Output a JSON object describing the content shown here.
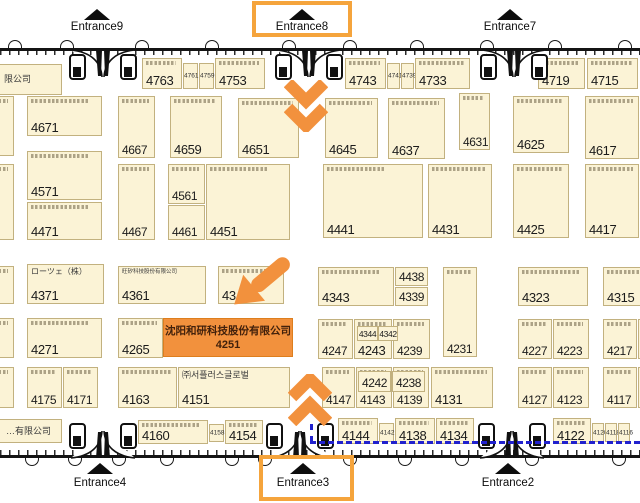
{
  "colors": {
    "booth_fill": "#FBF3D6",
    "booth_border": "#C2B17F",
    "highlight_orange": "#F2913D",
    "entrance_box_orange": "#F5A43C",
    "route_blue": "#2121CE",
    "wall_black": "#141414",
    "number_text": "#1b1b1b",
    "highlight_text": "#42210B"
  },
  "highlight_booth": {
    "company": "沈阳和研科技股份有限公司",
    "number": "4251",
    "x": 163,
    "y": 318,
    "w": 130,
    "h": 39
  },
  "entrances": {
    "top": [
      {
        "name": "Entrance9",
        "cx": 97,
        "door_cx": 103,
        "highlighted": false
      },
      {
        "name": "Entrance8",
        "cx": 302,
        "door_cx": 309,
        "highlighted": true
      },
      {
        "name": "Entrance7",
        "cx": 510,
        "door_cx": 514,
        "highlighted": false
      }
    ],
    "bottom": [
      {
        "name": "Entrance4",
        "cx": 100,
        "door_cx": 103,
        "highlighted": false
      },
      {
        "name": "Entrance3",
        "cx": 303,
        "door_cx": 300,
        "highlighted": true
      },
      {
        "name": "Entrance2",
        "cx": 508,
        "door_cx": 512,
        "highlighted": false
      }
    ]
  },
  "entrance_highlight_rects": [
    {
      "x": 252,
      "y": 1,
      "w": 100,
      "h": 36,
      "for": "Entrance8"
    },
    {
      "x": 259,
      "y": 455,
      "w": 95,
      "h": 46,
      "for": "Entrance3"
    }
  ],
  "booths": [
    {
      "lb": "限公司",
      "x": -46,
      "y": 64,
      "w": 108,
      "h": 31,
      "ls": 9,
      "lx": 49,
      "ly": 9
    },
    {
      "n": "4763",
      "x": 142,
      "y": 58,
      "w": 40,
      "h": 31,
      "m": 1
    },
    {
      "n": "4761",
      "x": 183,
      "y": 63,
      "w": 15,
      "h": 26,
      "s": 1
    },
    {
      "n": "4759",
      "x": 199,
      "y": 63,
      "w": 15,
      "h": 26,
      "s": 1
    },
    {
      "n": "4753",
      "x": 215,
      "y": 58,
      "w": 50,
      "h": 31,
      "m": 1
    },
    {
      "n": "4743",
      "x": 345,
      "y": 58,
      "w": 41,
      "h": 31,
      "m": 1
    },
    {
      "n": "4741",
      "x": 387,
      "y": 63,
      "w": 13,
      "h": 26,
      "s": 1
    },
    {
      "n": "4739",
      "x": 401,
      "y": 63,
      "w": 13,
      "h": 26,
      "s": 1
    },
    {
      "n": "4733",
      "x": 415,
      "y": 58,
      "w": 55,
      "h": 31,
      "m": 1
    },
    {
      "n": "4719",
      "x": 538,
      "y": 58,
      "w": 47,
      "h": 31,
      "m": 1
    },
    {
      "n": "4715",
      "x": 587,
      "y": 58,
      "w": 51,
      "h": 31,
      "m": 1
    },
    {
      "n": "4671",
      "x": 27,
      "y": 96,
      "w": 75,
      "h": 40,
      "m": 1
    },
    {
      "n": "4667",
      "x": 118,
      "y": 96,
      "w": 37,
      "h": 62,
      "m": 1
    },
    {
      "n": "4659",
      "x": 170,
      "y": 96,
      "w": 52,
      "h": 62,
      "m": 1
    },
    {
      "n": "4651",
      "x": 238,
      "y": 98,
      "w": 61,
      "h": 60,
      "m": 1
    },
    {
      "n": "4645",
      "x": 325,
      "y": 98,
      "w": 53,
      "h": 60,
      "m": 1
    },
    {
      "n": "4637",
      "x": 388,
      "y": 98,
      "w": 57,
      "h": 61,
      "m": 1
    },
    {
      "n": "4631",
      "x": 459,
      "y": 93,
      "w": 31,
      "h": 57,
      "m": 1
    },
    {
      "n": "4625",
      "x": 513,
      "y": 96,
      "w": 56,
      "h": 57,
      "m": 1
    },
    {
      "n": "4617",
      "x": 585,
      "y": 96,
      "w": 54,
      "h": 63,
      "m": 1
    },
    {
      "n": "4571",
      "x": 27,
      "y": 151,
      "w": 75,
      "h": 49,
      "m": 1
    },
    {
      "n": "4471",
      "x": 27,
      "y": 202,
      "w": 75,
      "h": 38,
      "m": 1
    },
    {
      "n": "4467",
      "x": 118,
      "y": 164,
      "w": 37,
      "h": 76,
      "m": 1
    },
    {
      "n": "4561",
      "x": 168,
      "y": 164,
      "w": 37,
      "h": 40,
      "m": 1
    },
    {
      "n": "4461",
      "x": 168,
      "y": 205,
      "w": 37,
      "h": 35
    },
    {
      "n": "4451",
      "x": 206,
      "y": 164,
      "w": 84,
      "h": 76,
      "m": 1
    },
    {
      "n": "4441",
      "x": 323,
      "y": 164,
      "w": 100,
      "h": 74,
      "m": 1
    },
    {
      "n": "4431",
      "x": 428,
      "y": 164,
      "w": 64,
      "h": 74,
      "m": 1
    },
    {
      "n": "4425",
      "x": 513,
      "y": 164,
      "w": 56,
      "h": 74,
      "m": 1
    },
    {
      "n": "4417",
      "x": 585,
      "y": 164,
      "w": 54,
      "h": 74,
      "m": 1
    },
    {
      "n": "4371",
      "x": 27,
      "y": 264,
      "w": 77,
      "h": 40,
      "lb": "ローツェ（株）",
      "ls": 8
    },
    {
      "n": "4361",
      "x": 118,
      "y": 266,
      "w": 88,
      "h": 38,
      "lb": "旺矽科技股份有限公司",
      "ls": 5.5
    },
    {
      "n": "43",
      "x": 218,
      "y": 266,
      "w": 66,
      "h": 38,
      "m": 1
    },
    {
      "n": "4343",
      "x": 318,
      "y": 267,
      "w": 76,
      "h": 39,
      "m": 1
    },
    {
      "n": "4438",
      "x": 395,
      "y": 267,
      "w": 33,
      "h": 19,
      "ctr": 1,
      "fs": 12
    },
    {
      "n": "4339",
      "x": 395,
      "y": 287,
      "w": 33,
      "h": 19,
      "ctr": 1,
      "fs": 12
    },
    {
      "n": "4231",
      "x": 443,
      "y": 267,
      "w": 34,
      "h": 90,
      "m": 1
    },
    {
      "n": "4323",
      "x": 518,
      "y": 267,
      "w": 70,
      "h": 39,
      "m": 1
    },
    {
      "n": "4315",
      "x": 603,
      "y": 267,
      "w": 43,
      "h": 39,
      "m": 1
    },
    {
      "n": "4271",
      "x": 27,
      "y": 318,
      "w": 75,
      "h": 40,
      "m": 1
    },
    {
      "n": "4265",
      "x": 118,
      "y": 318,
      "w": 45,
      "h": 40,
      "m": 1
    },
    {
      "n": "4247",
      "x": 318,
      "y": 319,
      "w": 35,
      "h": 40,
      "m": 1
    },
    {
      "n": "4243",
      "x": 354,
      "y": 319,
      "w": 38,
      "h": 40,
      "m": 1
    },
    {
      "n": "4344",
      "x": 357,
      "y": 326,
      "w": 21,
      "h": 15,
      "ctr": 1,
      "fs": 8.5
    },
    {
      "n": "4342",
      "x": 378,
      "y": 326,
      "w": 20,
      "h": 15,
      "ctr": 1,
      "fs": 8.5
    },
    {
      "n": "4239",
      "x": 393,
      "y": 319,
      "w": 37,
      "h": 40,
      "m": 1
    },
    {
      "n": "4227",
      "x": 518,
      "y": 319,
      "w": 34,
      "h": 40,
      "m": 1
    },
    {
      "n": "4223",
      "x": 553,
      "y": 319,
      "w": 36,
      "h": 40,
      "m": 1
    },
    {
      "n": "4217",
      "x": 603,
      "y": 319,
      "w": 34,
      "h": 40,
      "m": 1
    },
    {
      "x": 638,
      "y": 319,
      "w": 14,
      "h": 40,
      "m": 1
    },
    {
      "n": "4175",
      "x": 27,
      "y": 367,
      "w": 35,
      "h": 41,
      "m": 1
    },
    {
      "n": "4171",
      "x": 63,
      "y": 367,
      "w": 35,
      "h": 41,
      "m": 1
    },
    {
      "n": "4163",
      "x": 118,
      "y": 367,
      "w": 59,
      "h": 41,
      "m": 1
    },
    {
      "n": "4151",
      "x": 178,
      "y": 367,
      "w": 112,
      "h": 41,
      "lb": "㈜서플러스글로벌",
      "ls": 9
    },
    {
      "n": "4147",
      "x": 322,
      "y": 367,
      "w": 33,
      "h": 41,
      "m": 1
    },
    {
      "n": "4143",
      "x": 356,
      "y": 367,
      "w": 36,
      "h": 41,
      "m": 1
    },
    {
      "n": "4139",
      "x": 393,
      "y": 367,
      "w": 36,
      "h": 41,
      "m": 1
    },
    {
      "n": "4242",
      "x": 358,
      "y": 371,
      "w": 33,
      "h": 21,
      "ctr": 1,
      "fs": 12
    },
    {
      "n": "4238",
      "x": 392,
      "y": 371,
      "w": 33,
      "h": 21,
      "ctr": 1,
      "fs": 12
    },
    {
      "n": "4131",
      "x": 431,
      "y": 367,
      "w": 62,
      "h": 41,
      "m": 1
    },
    {
      "n": "4127",
      "x": 518,
      "y": 367,
      "w": 34,
      "h": 41,
      "m": 1
    },
    {
      "n": "4123",
      "x": 553,
      "y": 367,
      "w": 36,
      "h": 41,
      "m": 1
    },
    {
      "n": "4117",
      "x": 603,
      "y": 367,
      "w": 34,
      "h": 41,
      "m": 1
    },
    {
      "x": 638,
      "y": 367,
      "w": 14,
      "h": 41
    },
    {
      "lb": "…有限公司",
      "x": -40,
      "y": 419,
      "w": 102,
      "h": 24,
      "ls": 9,
      "lx": 45,
      "ly": 6
    },
    {
      "n": "4160",
      "x": 138,
      "y": 420,
      "w": 70,
      "h": 24,
      "m": 1
    },
    {
      "n": "4158",
      "x": 209,
      "y": 424,
      "w": 15,
      "h": 18,
      "s": 1
    },
    {
      "n": "4154",
      "x": 225,
      "y": 420,
      "w": 38,
      "h": 24,
      "m": 1
    },
    {
      "n": "4144",
      "x": 338,
      "y": 418,
      "w": 40,
      "h": 26,
      "m": 1
    },
    {
      "n": "4142",
      "x": 379,
      "y": 423,
      "w": 15,
      "h": 19,
      "s": 1
    },
    {
      "n": "4138",
      "x": 395,
      "y": 418,
      "w": 40,
      "h": 26,
      "m": 1
    },
    {
      "n": "4134",
      "x": 436,
      "y": 418,
      "w": 38,
      "h": 26,
      "m": 1
    },
    {
      "n": "4122",
      "x": 553,
      "y": 418,
      "w": 38,
      "h": 26,
      "m": 1
    },
    {
      "n": "4120",
      "x": 592,
      "y": 423,
      "w": 12,
      "h": 19,
      "s": 1
    },
    {
      "n": "4118",
      "x": 605,
      "y": 423,
      "w": 12,
      "h": 19,
      "s": 1
    },
    {
      "n": "4116",
      "x": 618,
      "y": 423,
      "w": 12,
      "h": 19,
      "s": 1
    },
    {
      "x": -18,
      "y": 96,
      "w": 32,
      "h": 60,
      "m": 1
    },
    {
      "x": -18,
      "y": 164,
      "w": 32,
      "h": 76,
      "m": 1
    },
    {
      "x": -18,
      "y": 266,
      "w": 32,
      "h": 38,
      "m": 1
    },
    {
      "x": -18,
      "y": 318,
      "w": 32,
      "h": 40,
      "m": 1
    },
    {
      "x": -18,
      "y": 367,
      "w": 32,
      "h": 41,
      "m": 1
    }
  ],
  "walls": {
    "top_y": 48,
    "bottom_y": 455
  },
  "decor": {
    "top_arc_x": [
      8,
      60,
      135,
      205,
      282,
      343,
      410,
      480,
      548,
      618
    ],
    "bottom_arc_x": [
      25,
      68,
      112,
      160,
      225,
      258,
      343,
      398,
      455,
      525,
      612
    ],
    "route_dashed": {
      "v": {
        "x": 310,
        "y": 424,
        "h": 18
      },
      "h": {
        "x": 310,
        "y": 441,
        "w": 330
      }
    },
    "chevron_down": {
      "x": 284,
      "y": 80
    },
    "chevron_up": {
      "x": 288,
      "y": 374
    },
    "target_arrow": {
      "x": 226,
      "y": 265,
      "angle": -40
    }
  }
}
